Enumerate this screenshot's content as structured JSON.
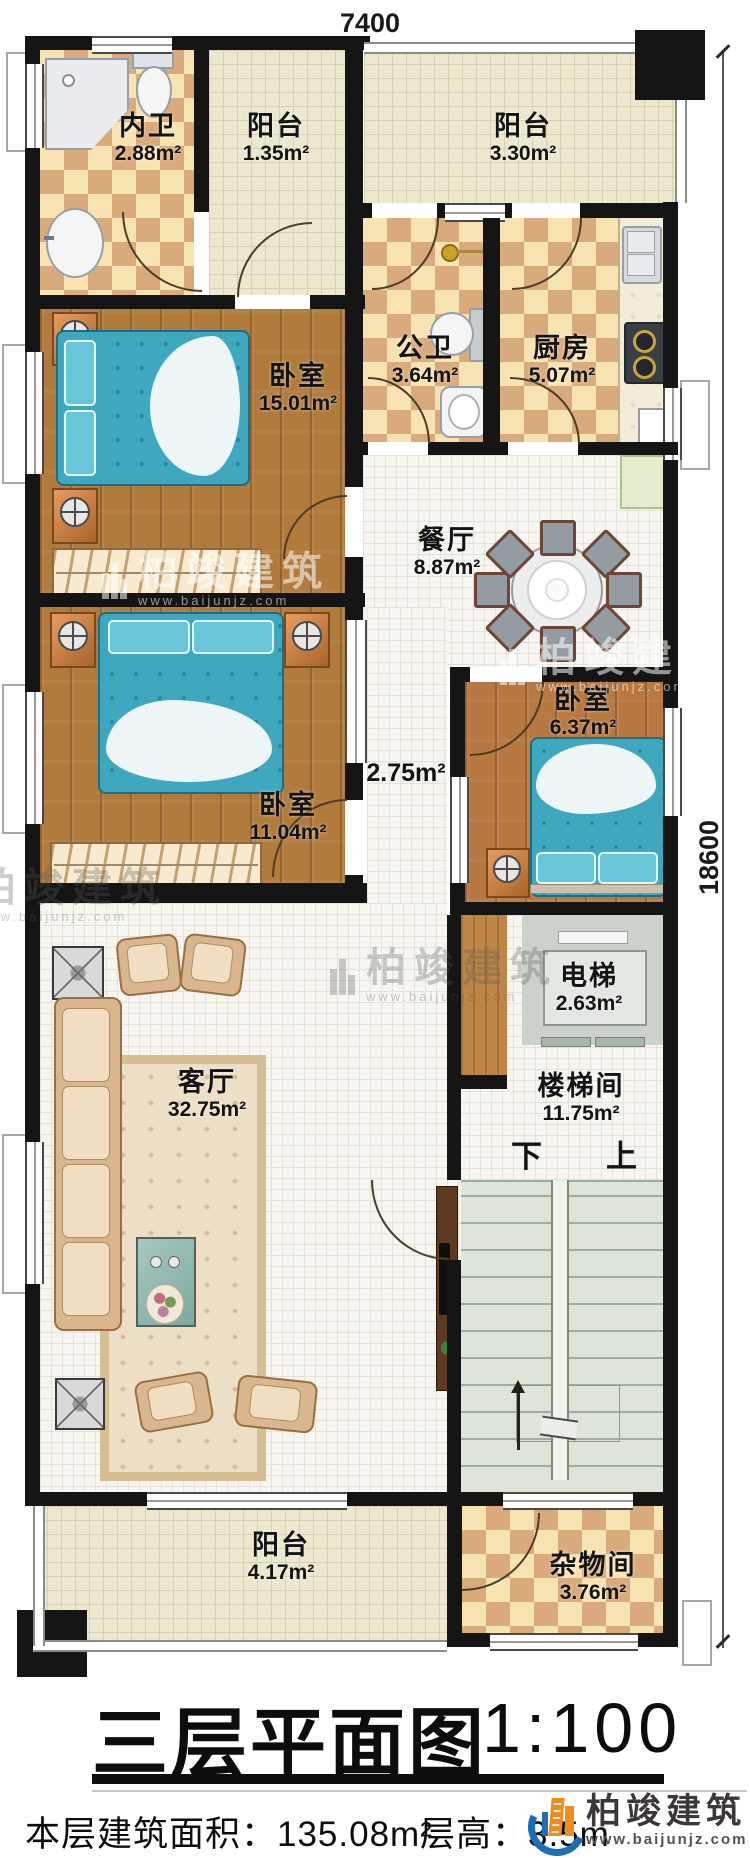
{
  "dimensions": {
    "top": "7400",
    "right": "18600"
  },
  "rooms": [
    {
      "name": "内卫",
      "area": "2.88m²"
    },
    {
      "name": "阳台",
      "area": "1.35m²"
    },
    {
      "name": "阳台",
      "area": "3.30m²"
    },
    {
      "name": "卧室",
      "area": "15.01m²"
    },
    {
      "name": "公卫",
      "area": "3.64m²"
    },
    {
      "name": "厨房",
      "area": "5.07m²"
    },
    {
      "name": "餐厅",
      "area": "8.87m²"
    },
    {
      "name": "卧室",
      "area": "11.04m²"
    },
    {
      "name": "卧室",
      "area": "6.37m²"
    },
    {
      "name": "",
      "area": "2.75m²"
    },
    {
      "name": "客厅",
      "area": "32.75m²"
    },
    {
      "name": "电梯",
      "area": "2.63m²"
    },
    {
      "name": "楼梯间",
      "area": "11.75m²"
    },
    {
      "name": "阳台",
      "area": "4.17m²"
    },
    {
      "name": "杂物间",
      "area": "3.76m²"
    }
  ],
  "stairs": {
    "down_label": "下",
    "up_label": "上"
  },
  "title": {
    "text": "三层平面图",
    "scale": "1:100"
  },
  "footer": {
    "area_label": "本层建筑面积：135.08m²",
    "height_label": "层高：3.5m"
  },
  "brand": {
    "name": "柏竣建筑",
    "url": "www.baijunjz.com"
  },
  "watermark": {
    "name": "柏竣建筑",
    "url": "www.baijunjz.com"
  },
  "colors": {
    "wall": "#151515",
    "wood": "#b07b3c",
    "checker_dark": "#d9ab7c",
    "tile_cream": "#ece7cf",
    "blue_bed": "#3fa8be",
    "brand_blue": "#1a6fb5",
    "brand_orange": "#f08c1e"
  }
}
